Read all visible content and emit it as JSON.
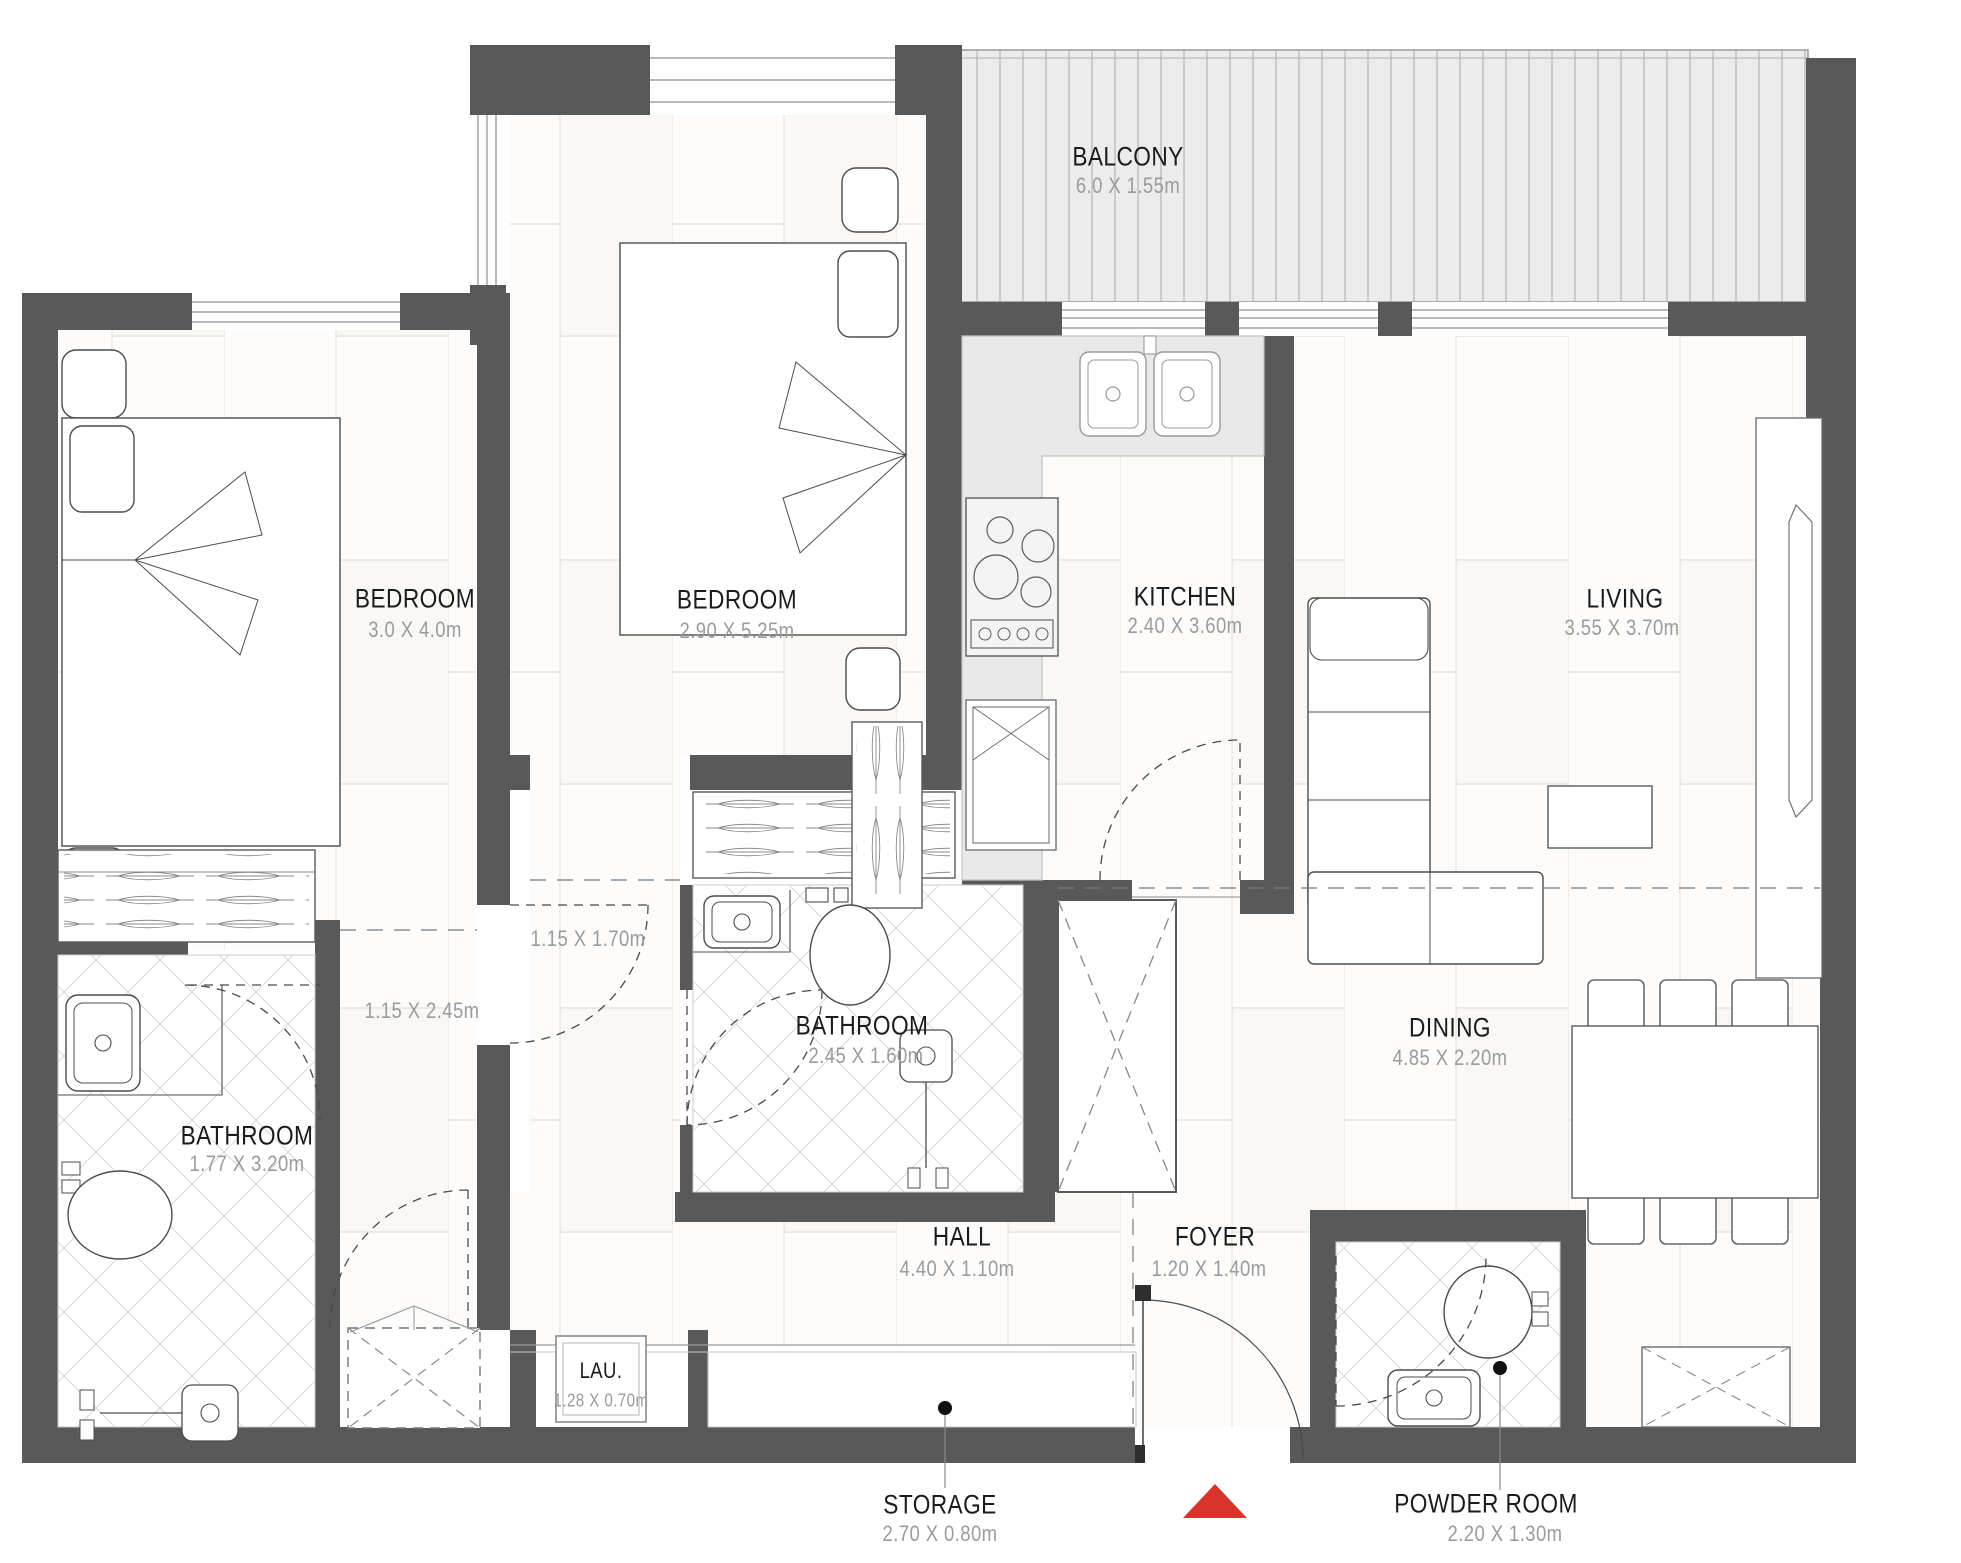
{
  "plan": {
    "title": "2-bedroom apartment floor plan",
    "rooms": {
      "balcony": {
        "name": "BALCONY",
        "dims": "6.0  X  1.55m"
      },
      "bedroom_left": {
        "name": "BEDROOM",
        "dims": "3.0  X  4.0m"
      },
      "bedroom_mid": {
        "name": "BEDROOM",
        "dims": "2.90  X  5.25m"
      },
      "kitchen": {
        "name": "KITCHEN",
        "dims": "2.40  X  3.60m"
      },
      "living": {
        "name": "LIVING",
        "dims": "3.55  X  3.70m"
      },
      "bathroom_mid": {
        "name": "BATHROOM",
        "dims": "2.45  X  1.60m"
      },
      "bathroom_left": {
        "name": "BATHROOM",
        "dims": "1.77  X  3.20m"
      },
      "dining": {
        "name": "DINING",
        "dims": "4.85  X  2.20m"
      },
      "hall": {
        "name": "HALL",
        "dims": "4.40  X  1.10m"
      },
      "foyer": {
        "name": "FOYER",
        "dims": "1.20  X  1.40m"
      },
      "laundry": {
        "name": "LAU.",
        "dims": "1.28  X  0.70m"
      },
      "storage": {
        "name": "STORAGE",
        "dims": "2.70  X  0.80m"
      },
      "powder": {
        "name": "POWDER ROOM",
        "dims": "2.20  X  1.30m"
      }
    },
    "annotations": {
      "corridor_a": "1.15  X  1.70m",
      "corridor_b": "1.15  X  2.45m"
    },
    "colors": {
      "wall": "#595959",
      "entrance_arrow": "#d8342c",
      "room_text": "#1b1b1b",
      "dim_text": "#9b9b9b"
    }
  }
}
